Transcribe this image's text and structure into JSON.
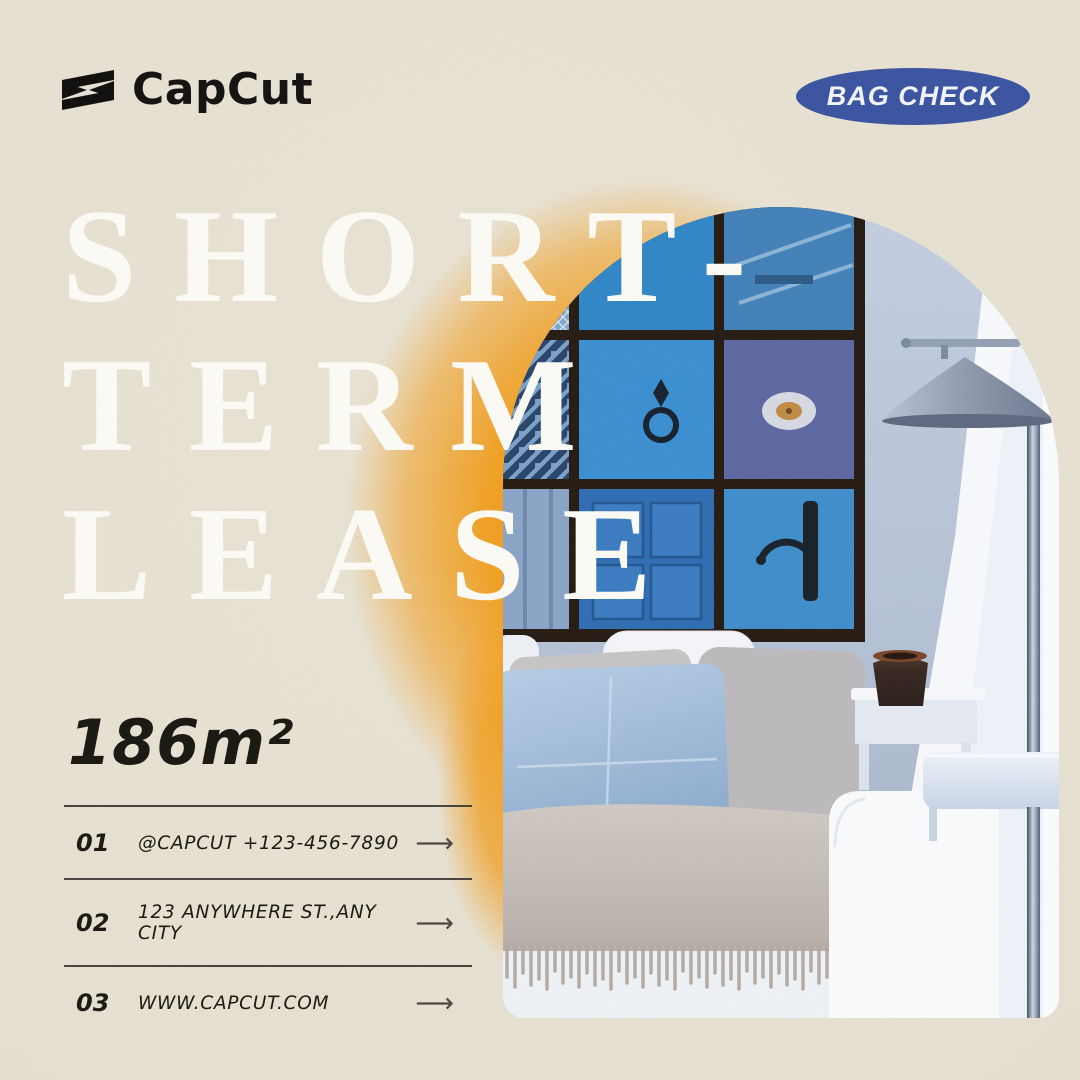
{
  "page": {
    "background": "#e7e1d2",
    "accent_orange": "#f19d1d"
  },
  "header": {
    "logo_text": "CapCut",
    "badge_label": "BAG CHECK",
    "badge_color": "#3a53a0"
  },
  "title": {
    "line1": "SHORT-",
    "line2": "TERM",
    "line3": "LEASE",
    "color": "#fcfbf5"
  },
  "area_label": "186m²",
  "contact_rows": [
    {
      "num": "01",
      "text": "@CAPCUT  +123-456-7890",
      "arrow": "⟶"
    },
    {
      "num": "02",
      "text": "123 ANYWHERE ST.,ANY CITY",
      "arrow": "⟶"
    },
    {
      "num": "03",
      "text": "WWW.CAPCUT.COM",
      "arrow": "⟶"
    }
  ],
  "photo": {
    "alt": "Arched photo of a living room: gallery wall of nine framed blue doors, conical floor lamp, white sofa with grey cushions, light-blue pillow, fringed throw, side table with dark vase"
  }
}
